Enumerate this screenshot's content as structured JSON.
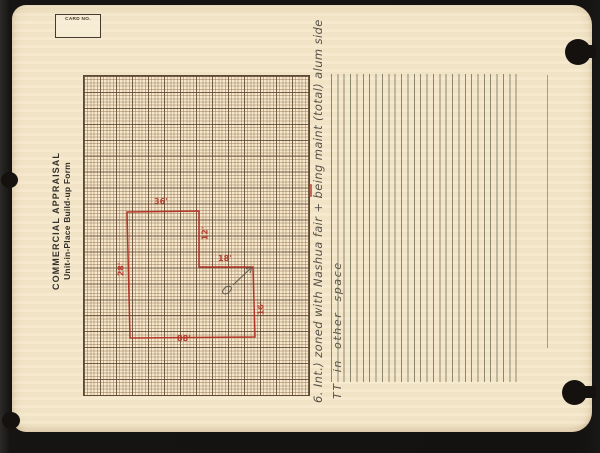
{
  "card": {
    "card_no_label": "CARD NO.",
    "title_line1": "COMMERCIAL APPRAISAL",
    "title_line2": "Unit-in-Place Build-up Form"
  },
  "sketch": {
    "dims": {
      "top": "36'",
      "notch_vertical": "12'",
      "notch_horizontal": "18'",
      "right": "16'",
      "bottom": "88'",
      "left": "28'"
    }
  },
  "notes": {
    "line1": "6. Int.) zoned with Nashua fair + being maint (total) alum side",
    "line2": "TT in other space"
  },
  "colors": {
    "paper": "#f5e8cb",
    "background": "#161412",
    "red_ink": "#b23527",
    "pencil": "#585349",
    "grid_line": "#8a6a4e",
    "rule_line": "#60604a"
  }
}
